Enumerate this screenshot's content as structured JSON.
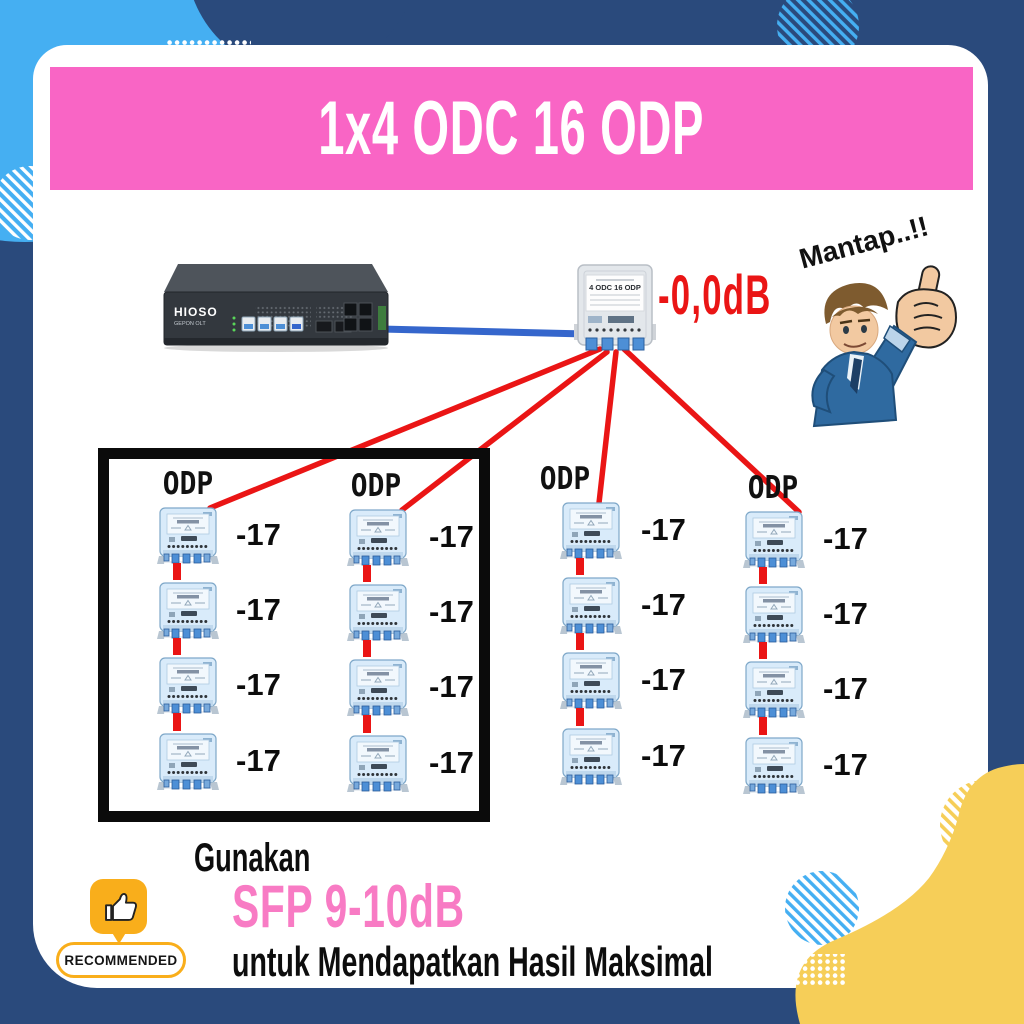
{
  "banner": {
    "title": "1x4 ODC 16 ODP"
  },
  "sticker": {
    "label": "Mantap..!!"
  },
  "diagram": {
    "olt": {
      "brand": "HIOSO",
      "sub": "GEPON OLT"
    },
    "odc": {
      "label": "4 ODC 16 ODP",
      "loss": "-0,0dB"
    },
    "odp_columns": [
      {
        "header": "ODP",
        "values": [
          "-17",
          "-17",
          "-17",
          "-17"
        ]
      },
      {
        "header": "ODP",
        "values": [
          "-17",
          "-17",
          "-17",
          "-17"
        ]
      },
      {
        "header": "ODP",
        "values": [
          "-17",
          "-17",
          "-17",
          "-17"
        ]
      },
      {
        "header": "ODP",
        "values": [
          "-17",
          "-17",
          "-17",
          "-17"
        ]
      }
    ]
  },
  "footer": {
    "line1": "Gunakan",
    "highlight": "SFP 9-10dB",
    "line3": "untuk Mendapatkan Hasil Maksimal"
  },
  "badge": {
    "label": "RECOMMENDED"
  },
  "colors": {
    "navy": "#2A4A7C",
    "sky": "#45AFF2",
    "pink": "#F965C5",
    "pink_text": "#F87BC4",
    "yellow": "#F6CE58",
    "red": "#EA1515",
    "badge_orange": "#F9AE1B",
    "cable_blue": "#3566CC"
  }
}
